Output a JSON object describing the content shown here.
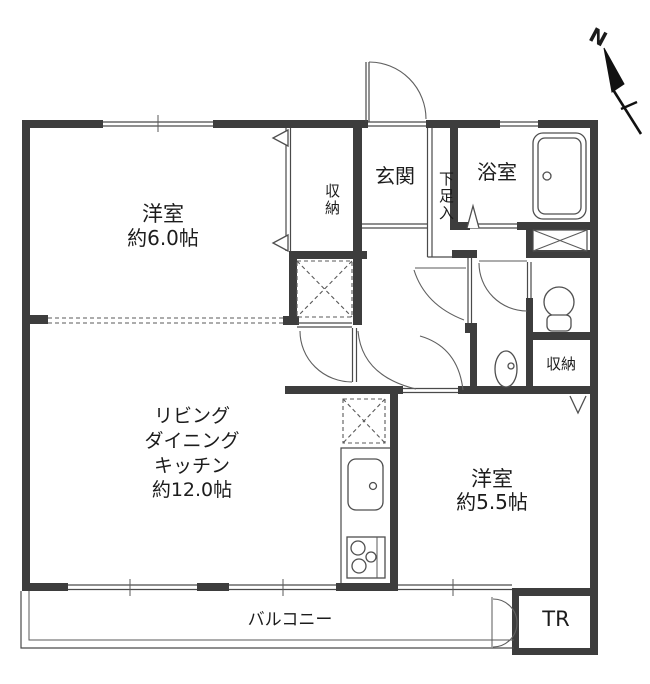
{
  "floorplan": {
    "compass": {
      "north_label": "N"
    },
    "rooms": {
      "bedroom_west": {
        "name": "洋室",
        "size": "約6.0帖"
      },
      "ldk": {
        "line1": "リビング",
        "line2": "ダイニング",
        "line3": "キッチン",
        "line4": "約12.0帖"
      },
      "bedroom_east": {
        "name": "洋室",
        "size": "約5.5帖"
      },
      "entrance": {
        "name": "玄関"
      },
      "shoe_cabinet": {
        "name": "下足入"
      },
      "bathroom": {
        "name": "浴室"
      },
      "closet_west": {
        "name": "収納"
      },
      "closet_east": {
        "name": "収納"
      },
      "balcony": {
        "name": "バルコニー"
      },
      "trunk_room": {
        "name": "TR"
      }
    }
  }
}
